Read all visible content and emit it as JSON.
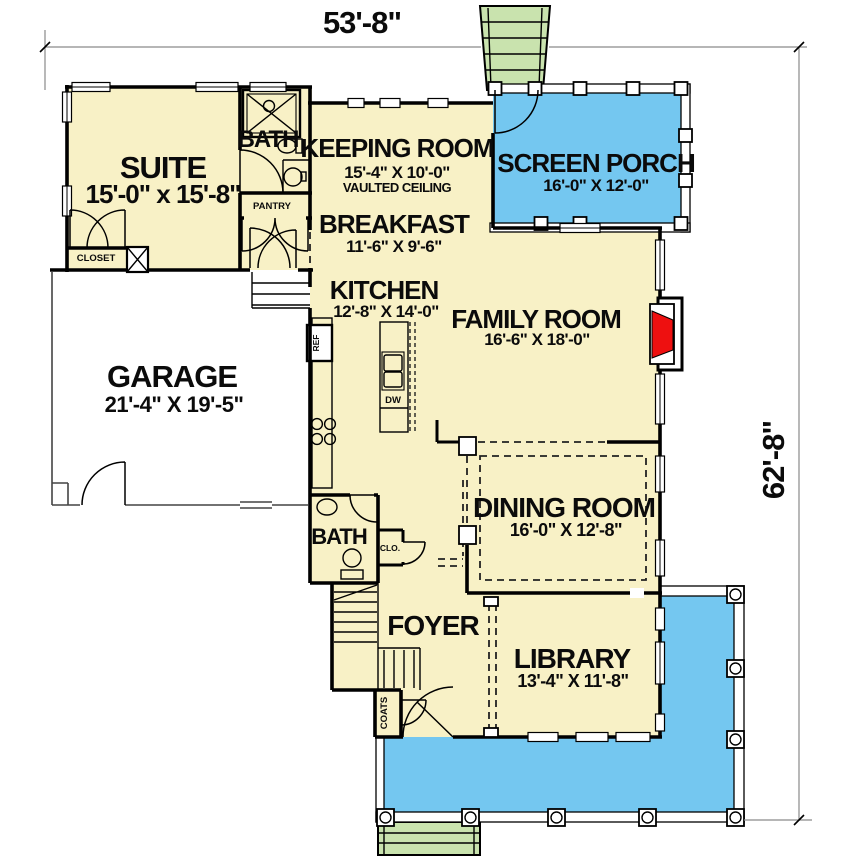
{
  "drawing": {
    "dim_width": "53'-8\"",
    "dim_height": "62'-8\"",
    "rooms": {
      "suite": {
        "name": "SUITE",
        "dims": "15'-0\" x 15'-8\""
      },
      "suite_bath": {
        "name": "BATH"
      },
      "pantry": {
        "name": "PANTRY"
      },
      "closet": {
        "name": "CLOSET"
      },
      "keeping": {
        "name": "KEEPING ROOM",
        "dims": "15'-4\" X 10'-0\"",
        "note": "VAULTED CEILING"
      },
      "screen_porch": {
        "name": "SCREEN PORCH",
        "dims": "16'-0\" X 12'-0\""
      },
      "breakfast": {
        "name": "BREAKFAST",
        "dims": "11'-6\" X 9'-6\""
      },
      "kitchen": {
        "name": "KITCHEN",
        "dims": "12'-8\" X 14'-0\""
      },
      "family": {
        "name": "FAMILY ROOM",
        "dims": "16'-6\" X 18'-0\""
      },
      "garage": {
        "name": "GARAGE",
        "dims": "21'-4\" X 19'-5\""
      },
      "dining": {
        "name": "DINING ROOM",
        "dims": "16'-0\" X 12'-8\""
      },
      "half_bath": {
        "name": "BATH"
      },
      "clo": {
        "name": "CLO."
      },
      "foyer": {
        "name": "FOYER"
      },
      "library": {
        "name": "LIBRARY",
        "dims": "13'-4\" X 11'-8\""
      },
      "coats": {
        "name": "COATS"
      }
    },
    "appliances": {
      "ref": "REF",
      "dw": "DW"
    },
    "colors": {
      "floor": "#F8F1C6",
      "porch": "#74C7F0",
      "steps": "#C9E3AE",
      "fireplace": "#EE1010"
    }
  }
}
